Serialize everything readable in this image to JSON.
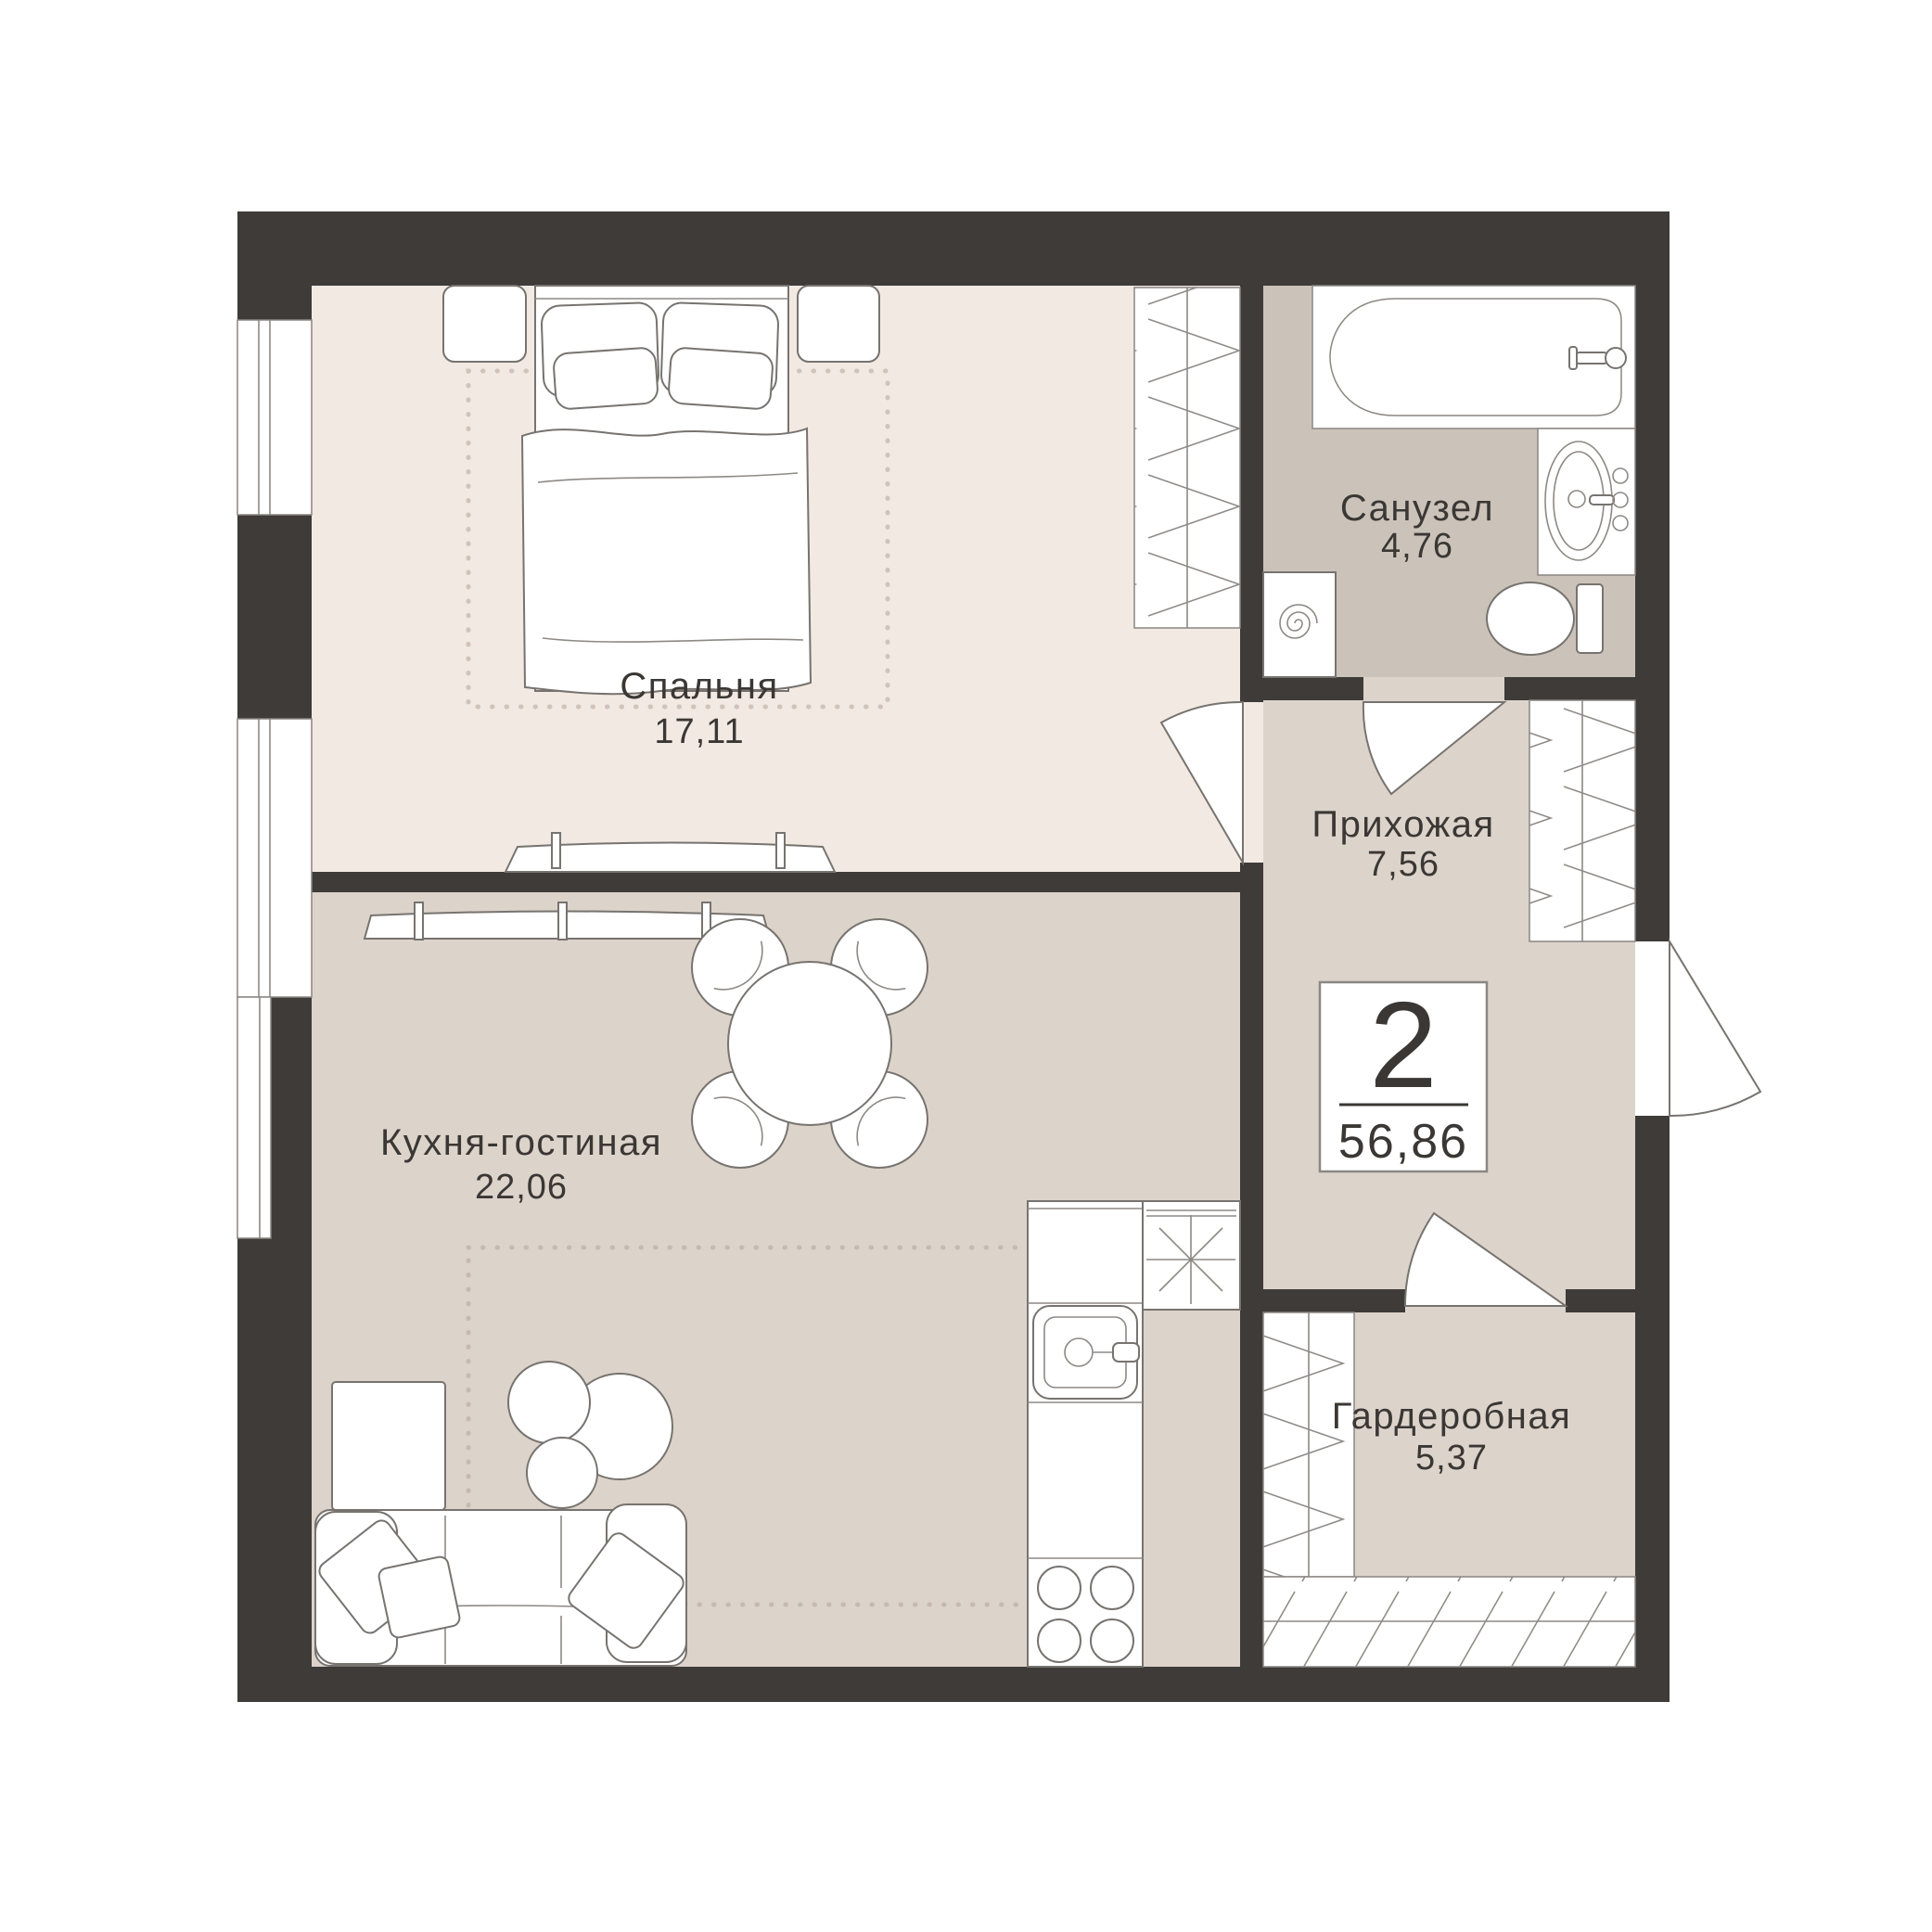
{
  "badge": {
    "rooms_count": "2",
    "total_area": "56,86"
  },
  "rooms": [
    {
      "name": "Спальня",
      "area": "17,11"
    },
    {
      "name": "Кухня-гостиная",
      "area": "22,06"
    },
    {
      "name": "Санузел",
      "area": "4,76"
    },
    {
      "name": "Прихожая",
      "area": "7,56"
    },
    {
      "name": "Гардеробная",
      "area": "5,37"
    }
  ],
  "colors": {
    "wall": "#3e3b39",
    "bedroom_floor": "#f2e9e3",
    "living_floor": "#dcd3cb",
    "hallway_floor": "#dcd3cb",
    "wardrobe_floor": "#dcd3cb",
    "bathroom_floor": "#cbc3ba",
    "furniture_line": "#77736f",
    "label_text": "#3a3734",
    "background": "#ffffff"
  }
}
